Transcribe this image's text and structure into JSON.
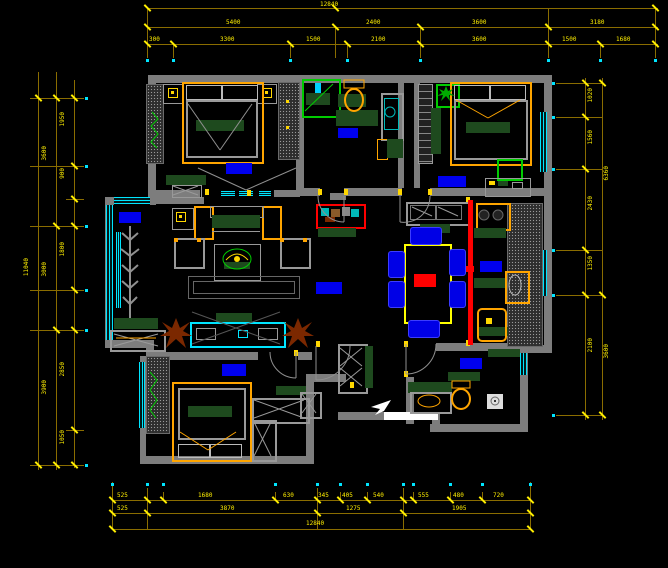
{
  "app": {
    "type": "cad-floor-plan",
    "description": "apartment furniture layout plan, black background CAD style"
  },
  "colors": {
    "background": "#000000",
    "walls": "#7d7d7d",
    "dimension_lines": "#8a6d00",
    "dimension_text": "#ffef00",
    "windows": "#00e5ff",
    "room_label_box": "#0000ee",
    "furniture_frame": "#ffa500",
    "counters_cushions": "#1e4a1e",
    "plant_green": "#00cc00",
    "plant_brown": "#7b2800",
    "sliding_door": "#ff0000",
    "threshold": "#ffffff",
    "dining_chairs": "#0000e6",
    "table_outline": "#ffff00"
  },
  "rooms": [
    {
      "id": "bedroom-top-left"
    },
    {
      "id": "bathroom-top"
    },
    {
      "id": "bedroom-top-right"
    },
    {
      "id": "balcony-left"
    },
    {
      "id": "living-room"
    },
    {
      "id": "dining-area"
    },
    {
      "id": "kitchen"
    },
    {
      "id": "bedroom-bottom-left"
    },
    {
      "id": "bathroom-bottom-right"
    },
    {
      "id": "entry-hall"
    }
  ],
  "room_labels": {
    "style": "solid-blue-box",
    "count": 8,
    "text_legible": false
  },
  "furniture": [
    "double-bed",
    "double-bed",
    "double-bed",
    "wardrobe",
    "nightstands-with-lamps",
    "sofa-set",
    "coffee-table-with-plant",
    "tv-cabinet",
    "dining-table-6-chairs",
    "buffet-cabinet",
    "stove",
    "kitchen-sink",
    "toilet",
    "toilet",
    "shower-enclosure",
    "washing-machine",
    "entry-closet",
    "shoe-cabinet",
    "potted-plants",
    "aquarium-cabinet"
  ],
  "symbols": {
    "entry_arrow": "white-arrow",
    "sliding_door": "red-line",
    "windows": "cyan-triple-line",
    "door_swings": "gray-quarter-arcs"
  },
  "dims": {
    "top_row1": [
      "12840"
    ],
    "top_row2": [
      "5400",
      "2400",
      "3600",
      "3180"
    ],
    "top_row3": [
      "300",
      "3300",
      "1500",
      "2100",
      "3600",
      "1500",
      "1680"
    ],
    "bottom_row1": [
      "525",
      "1680",
      "630",
      "345",
      "405",
      "540",
      "555",
      "480",
      "720"
    ],
    "bottom_row2": [
      "525",
      "3870",
      "1275",
      "1905"
    ],
    "bottom_row3": [
      "12840"
    ],
    "left_inner": [
      "1950",
      "900",
      "1800",
      "2850",
      "1050"
    ],
    "left_mid": [
      "3600",
      "3000",
      "3900"
    ],
    "left_outer": [
      "11040"
    ],
    "right_inner": [
      "1020",
      "1560",
      "2430",
      "1350",
      "2100"
    ],
    "right_outer": [
      "6360",
      "3600"
    ]
  }
}
